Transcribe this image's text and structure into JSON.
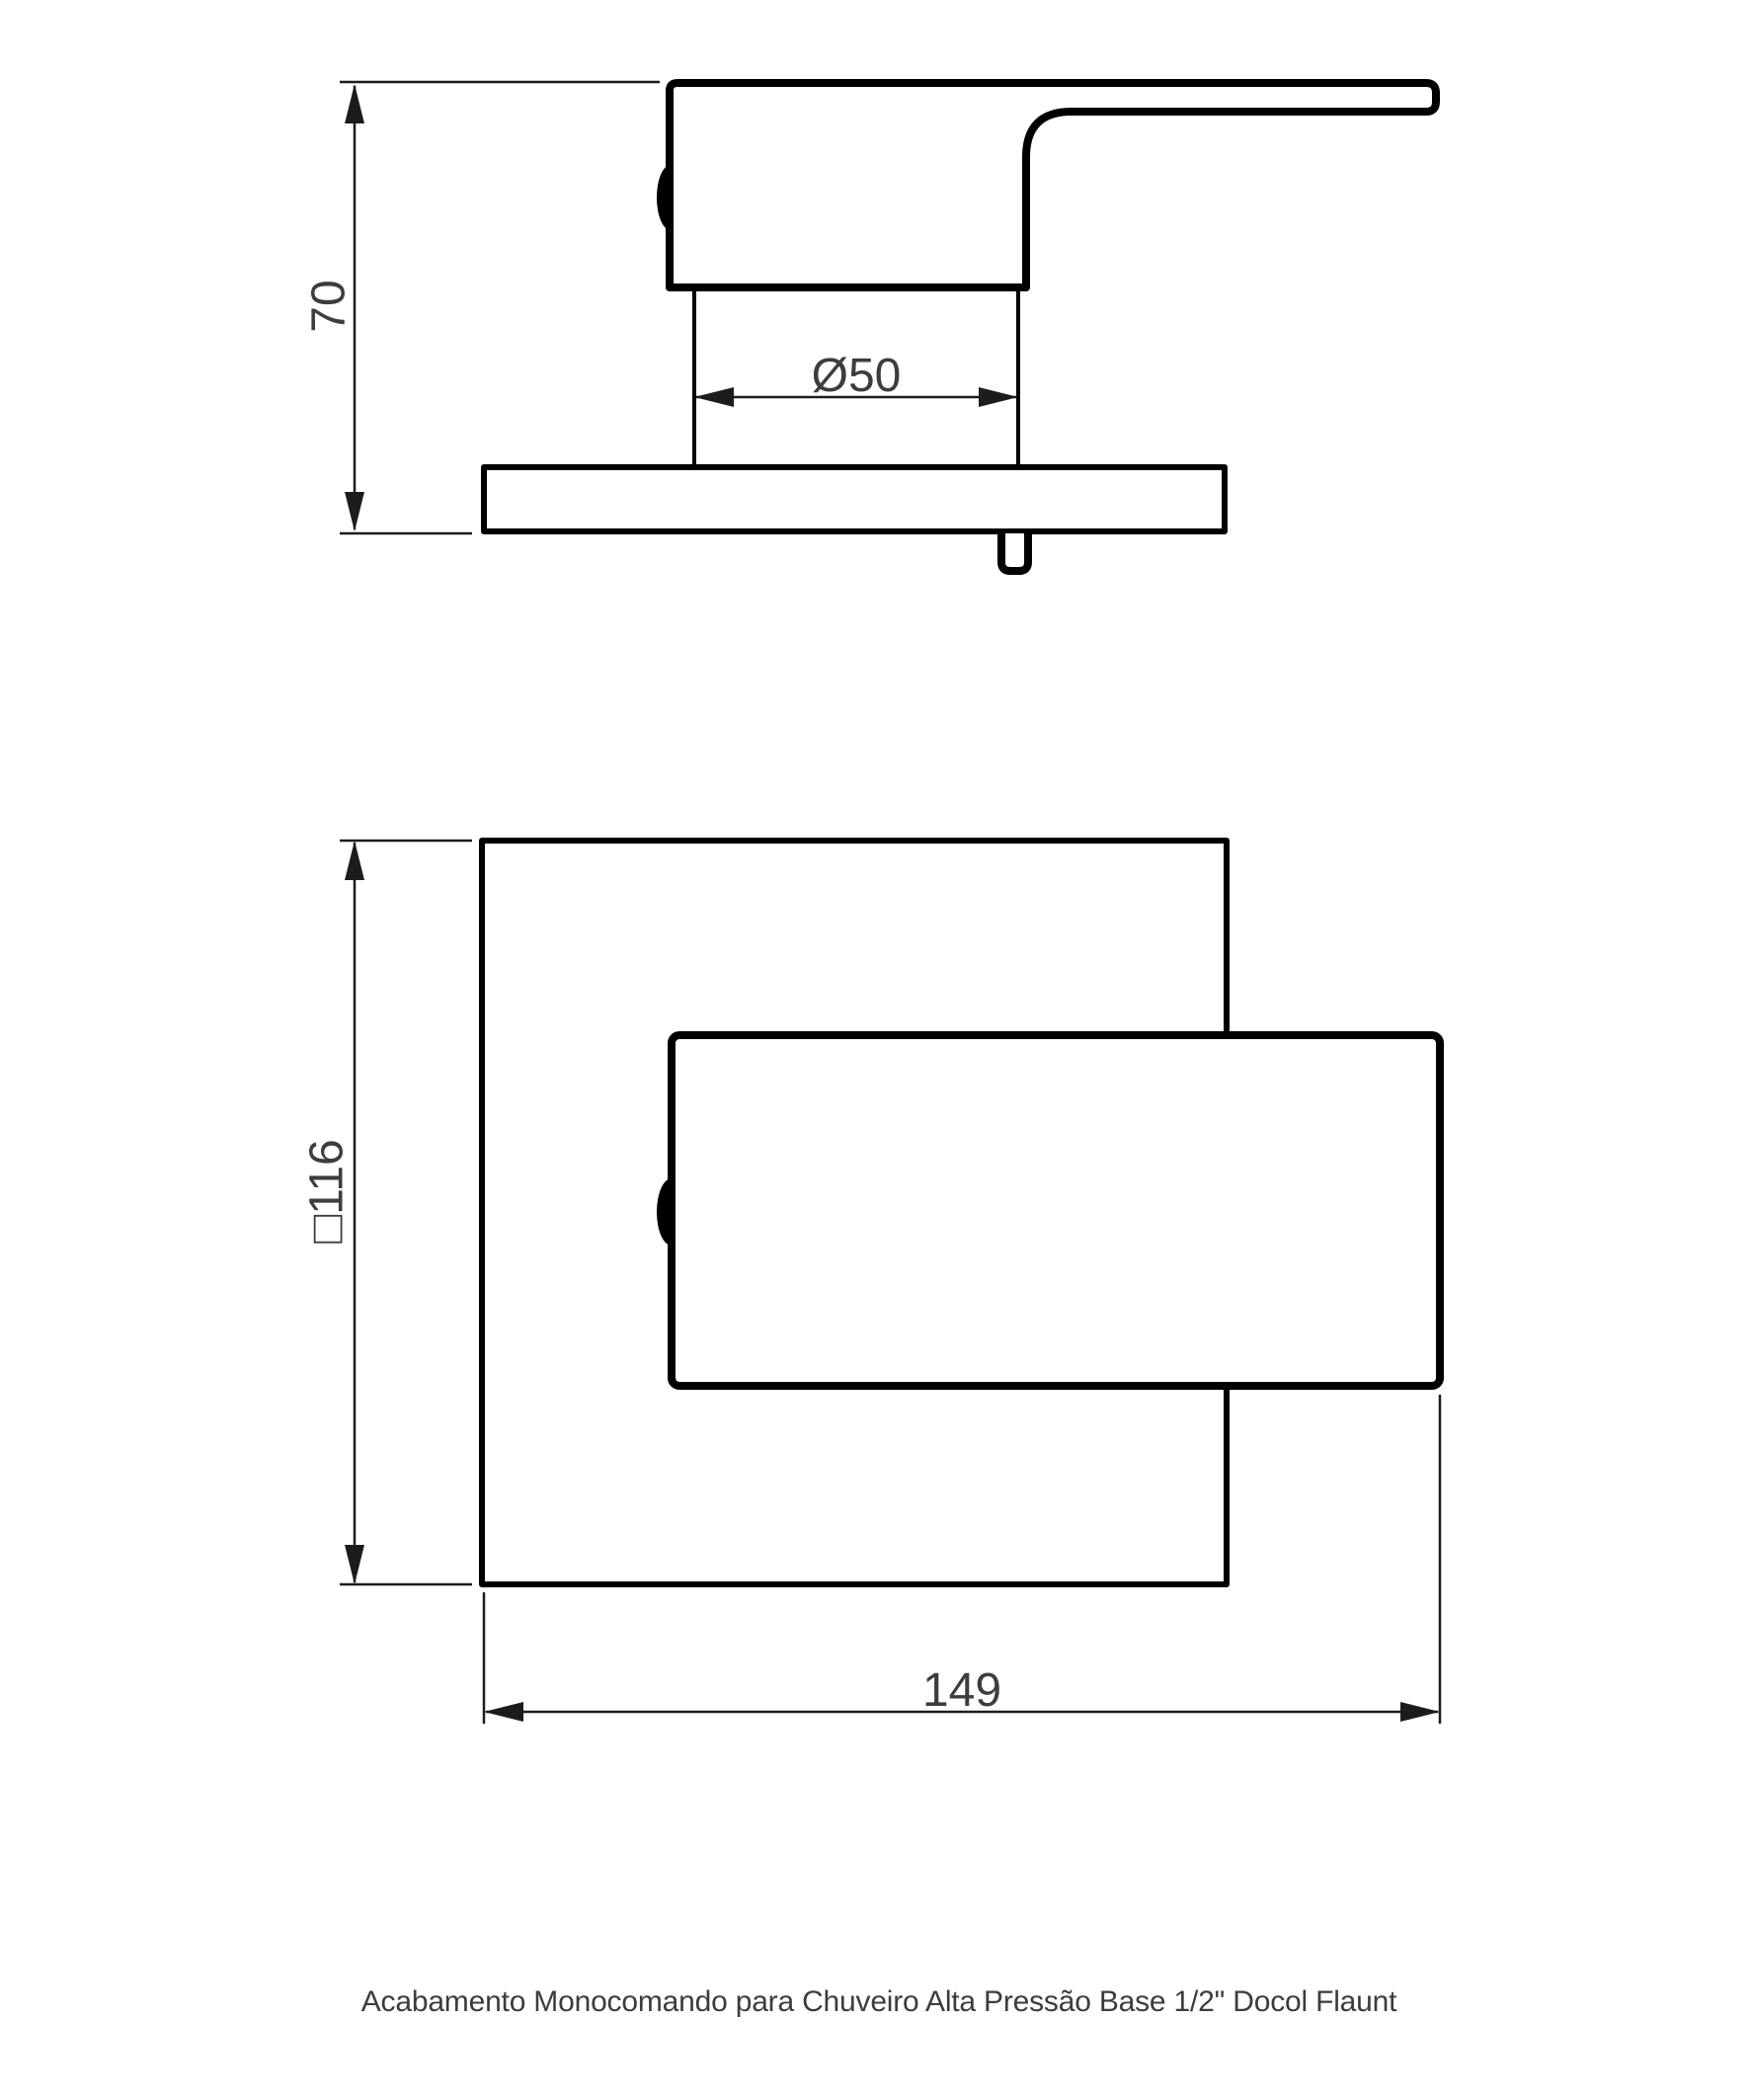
{
  "page": {
    "background_color": "#ffffff",
    "caption": "Acabamento Monocomando para Chuveiro Alta Pressão Base 1/2\" Docol Flaunt"
  },
  "drawing": {
    "line_color": "#000000",
    "dim_line_color": "#1c1c1c",
    "dim_text_color": "#3d3d3d",
    "caption_color": "#3c3c3c",
    "views": {
      "side": {
        "dims": {
          "height": {
            "label": "70"
          },
          "diameter": {
            "label": "Ø50"
          }
        }
      },
      "front": {
        "dims": {
          "plate": {
            "label": "□116"
          },
          "width": {
            "label": "149"
          }
        }
      }
    }
  }
}
